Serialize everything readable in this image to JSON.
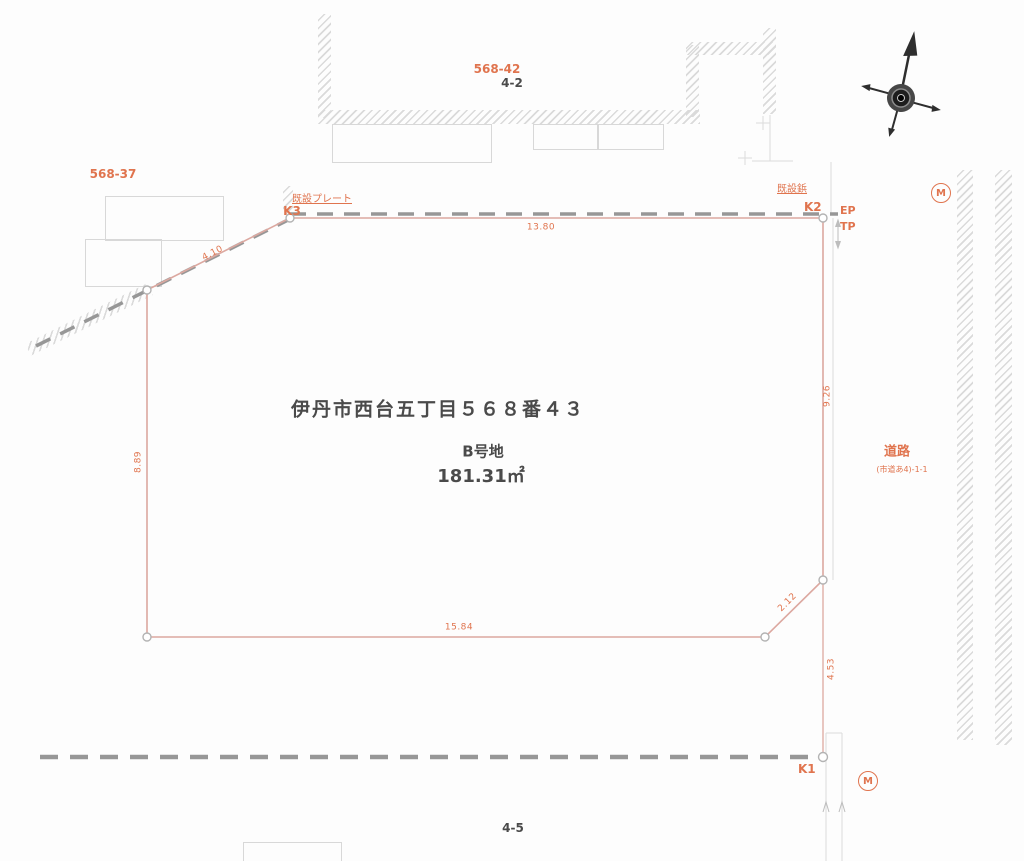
{
  "colors": {
    "accent": "#E0744E",
    "boundary": "#DCA8A0",
    "dash": "#979797",
    "faint": "#D8D8D8",
    "hatch": "#DADADA",
    "ink": "#4A4A4A",
    "compass": "#2E2E2E"
  },
  "parcels": {
    "top": "568-42",
    "top_sub": "4-2",
    "left": "568-37",
    "bottom": "4-5"
  },
  "survey_points": {
    "k1": "K1",
    "k2": "K2",
    "k3": "K3",
    "ep": "EP",
    "tp": "TP",
    "m_top": "M",
    "m_bottom": "M",
    "plate_note": "既設プレート",
    "pin_note": "既設鋲"
  },
  "dimensions": {
    "top": "13.80",
    "right": "9.26",
    "left": "8.89",
    "bottom": "15.84",
    "diag_bottom_right": "2.12",
    "diag_top_left": "4.10",
    "right_lower": "4.53"
  },
  "parcel_info": {
    "address": "伊丹市西台五丁目５６８番４３",
    "lot": "B号地",
    "area": "181.31㎡"
  },
  "road": {
    "label": "道路",
    "sub": "(市道あ4)-1-1"
  }
}
